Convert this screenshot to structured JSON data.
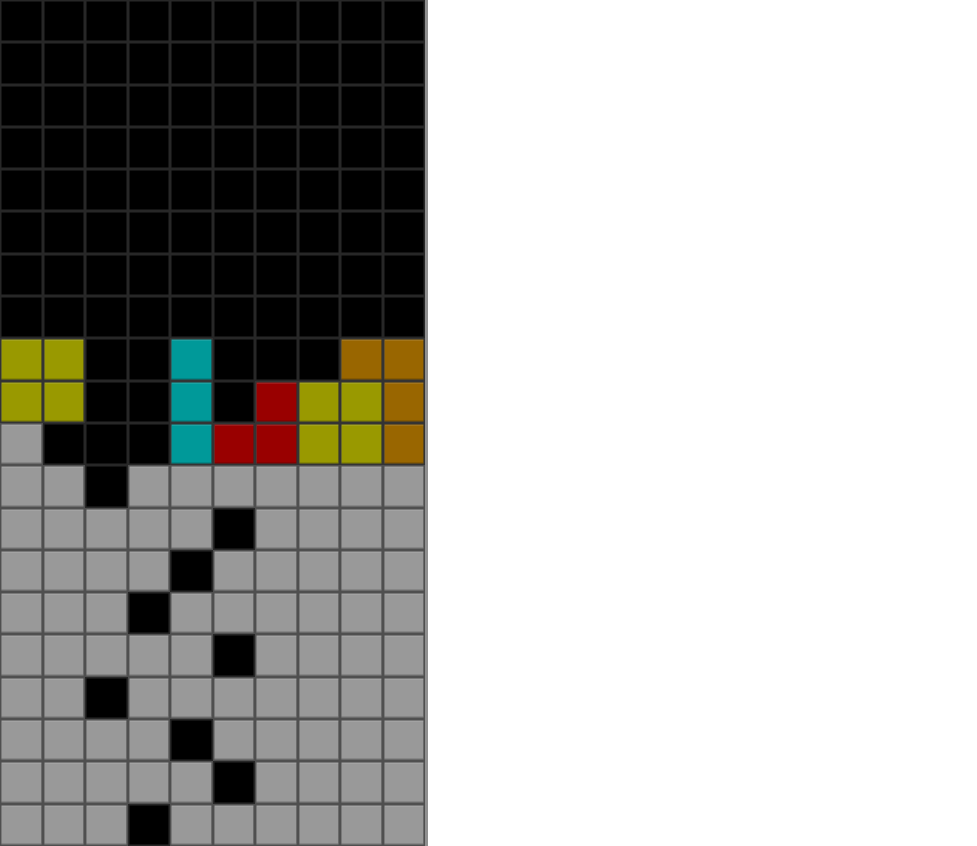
{
  "app": {
    "name": "tetris-playfield",
    "background": "#ffffff"
  },
  "board": {
    "columns": 10,
    "row_count": 20,
    "border_right_color": "#8f8f8f",
    "cell_types": {
      ".": {
        "name": "empty",
        "fill": "#000000",
        "line": "#272727"
      },
      "Y": {
        "name": "olive-block",
        "fill": "#999900",
        "line": "#333333"
      },
      "C": {
        "name": "teal-block",
        "fill": "#009999",
        "line": "#333333"
      },
      "R": {
        "name": "red-block",
        "fill": "#990000",
        "line": "#333333"
      },
      "O": {
        "name": "orange-block",
        "fill": "#996600",
        "line": "#333333"
      },
      "G": {
        "name": "garbage-block",
        "fill": "#999999",
        "line": "#4f4f4f"
      }
    },
    "rows": [
      "..........",
      "..........",
      "..........",
      "..........",
      "..........",
      "..........",
      "..........",
      "..........",
      "YY..C...OO",
      "YY..C.RYYO",
      "G...CRRYYO",
      "GG.GGGGGGG",
      "GGGGG.GGGG",
      "GGGG.GGGGG",
      "GGG.GGGGGG",
      "GGGGG.GGGG",
      "GG.GGGGGGG",
      "GGGG.GGGGG",
      "GGGGG.GGGG",
      "GGG.GGGGGG"
    ]
  }
}
